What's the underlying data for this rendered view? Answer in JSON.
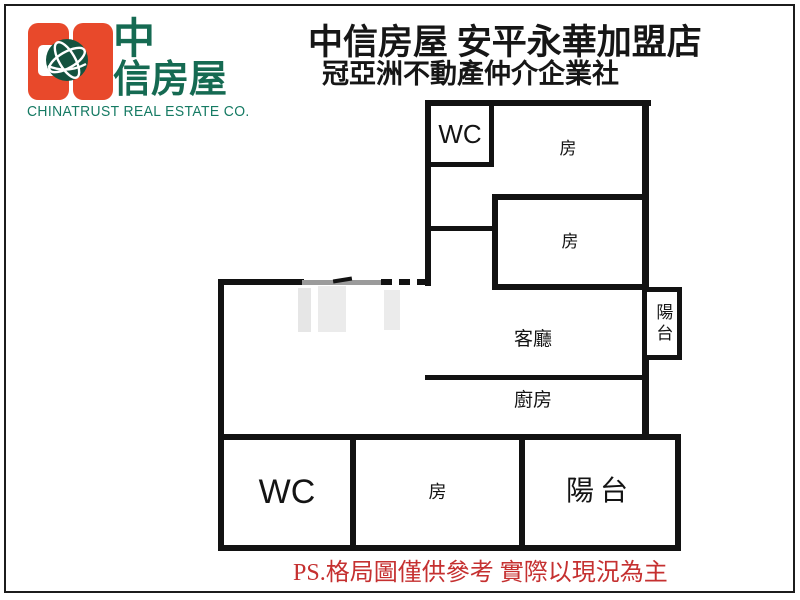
{
  "page": {
    "background": "#ffffff",
    "frame_color": "#1c1c1c"
  },
  "branding": {
    "logo_char_top": "中",
    "logo_chars_bottom": "信房屋",
    "caption": "CHINATRUST REAL ESTATE CO.",
    "colors": {
      "orange": "#e8492b",
      "text_green": "#156a52",
      "caption_green": "#157a63",
      "globe_green": "#14523f"
    }
  },
  "header": {
    "title": "中信房屋 安平永華加盟店",
    "subtitle": "冠亞洲不動產仲介企業社",
    "text_color": "#161616"
  },
  "floorplan": {
    "wall_color": "#121212",
    "gray_wall_color": "#9b9b9b",
    "rooms": {
      "wc_upper": "WC",
      "bedroom_top": "房",
      "bedroom_middle": "房",
      "living_room": "客廳",
      "kitchen": "廚房",
      "balcony_side": "陽台",
      "wc_lower": "WC",
      "bedroom_lower": "房",
      "balcony_lower": "陽台"
    }
  },
  "footer": {
    "note": "PS.格局圖僅供參考 實際以現況為主",
    "color": "#c53030"
  }
}
